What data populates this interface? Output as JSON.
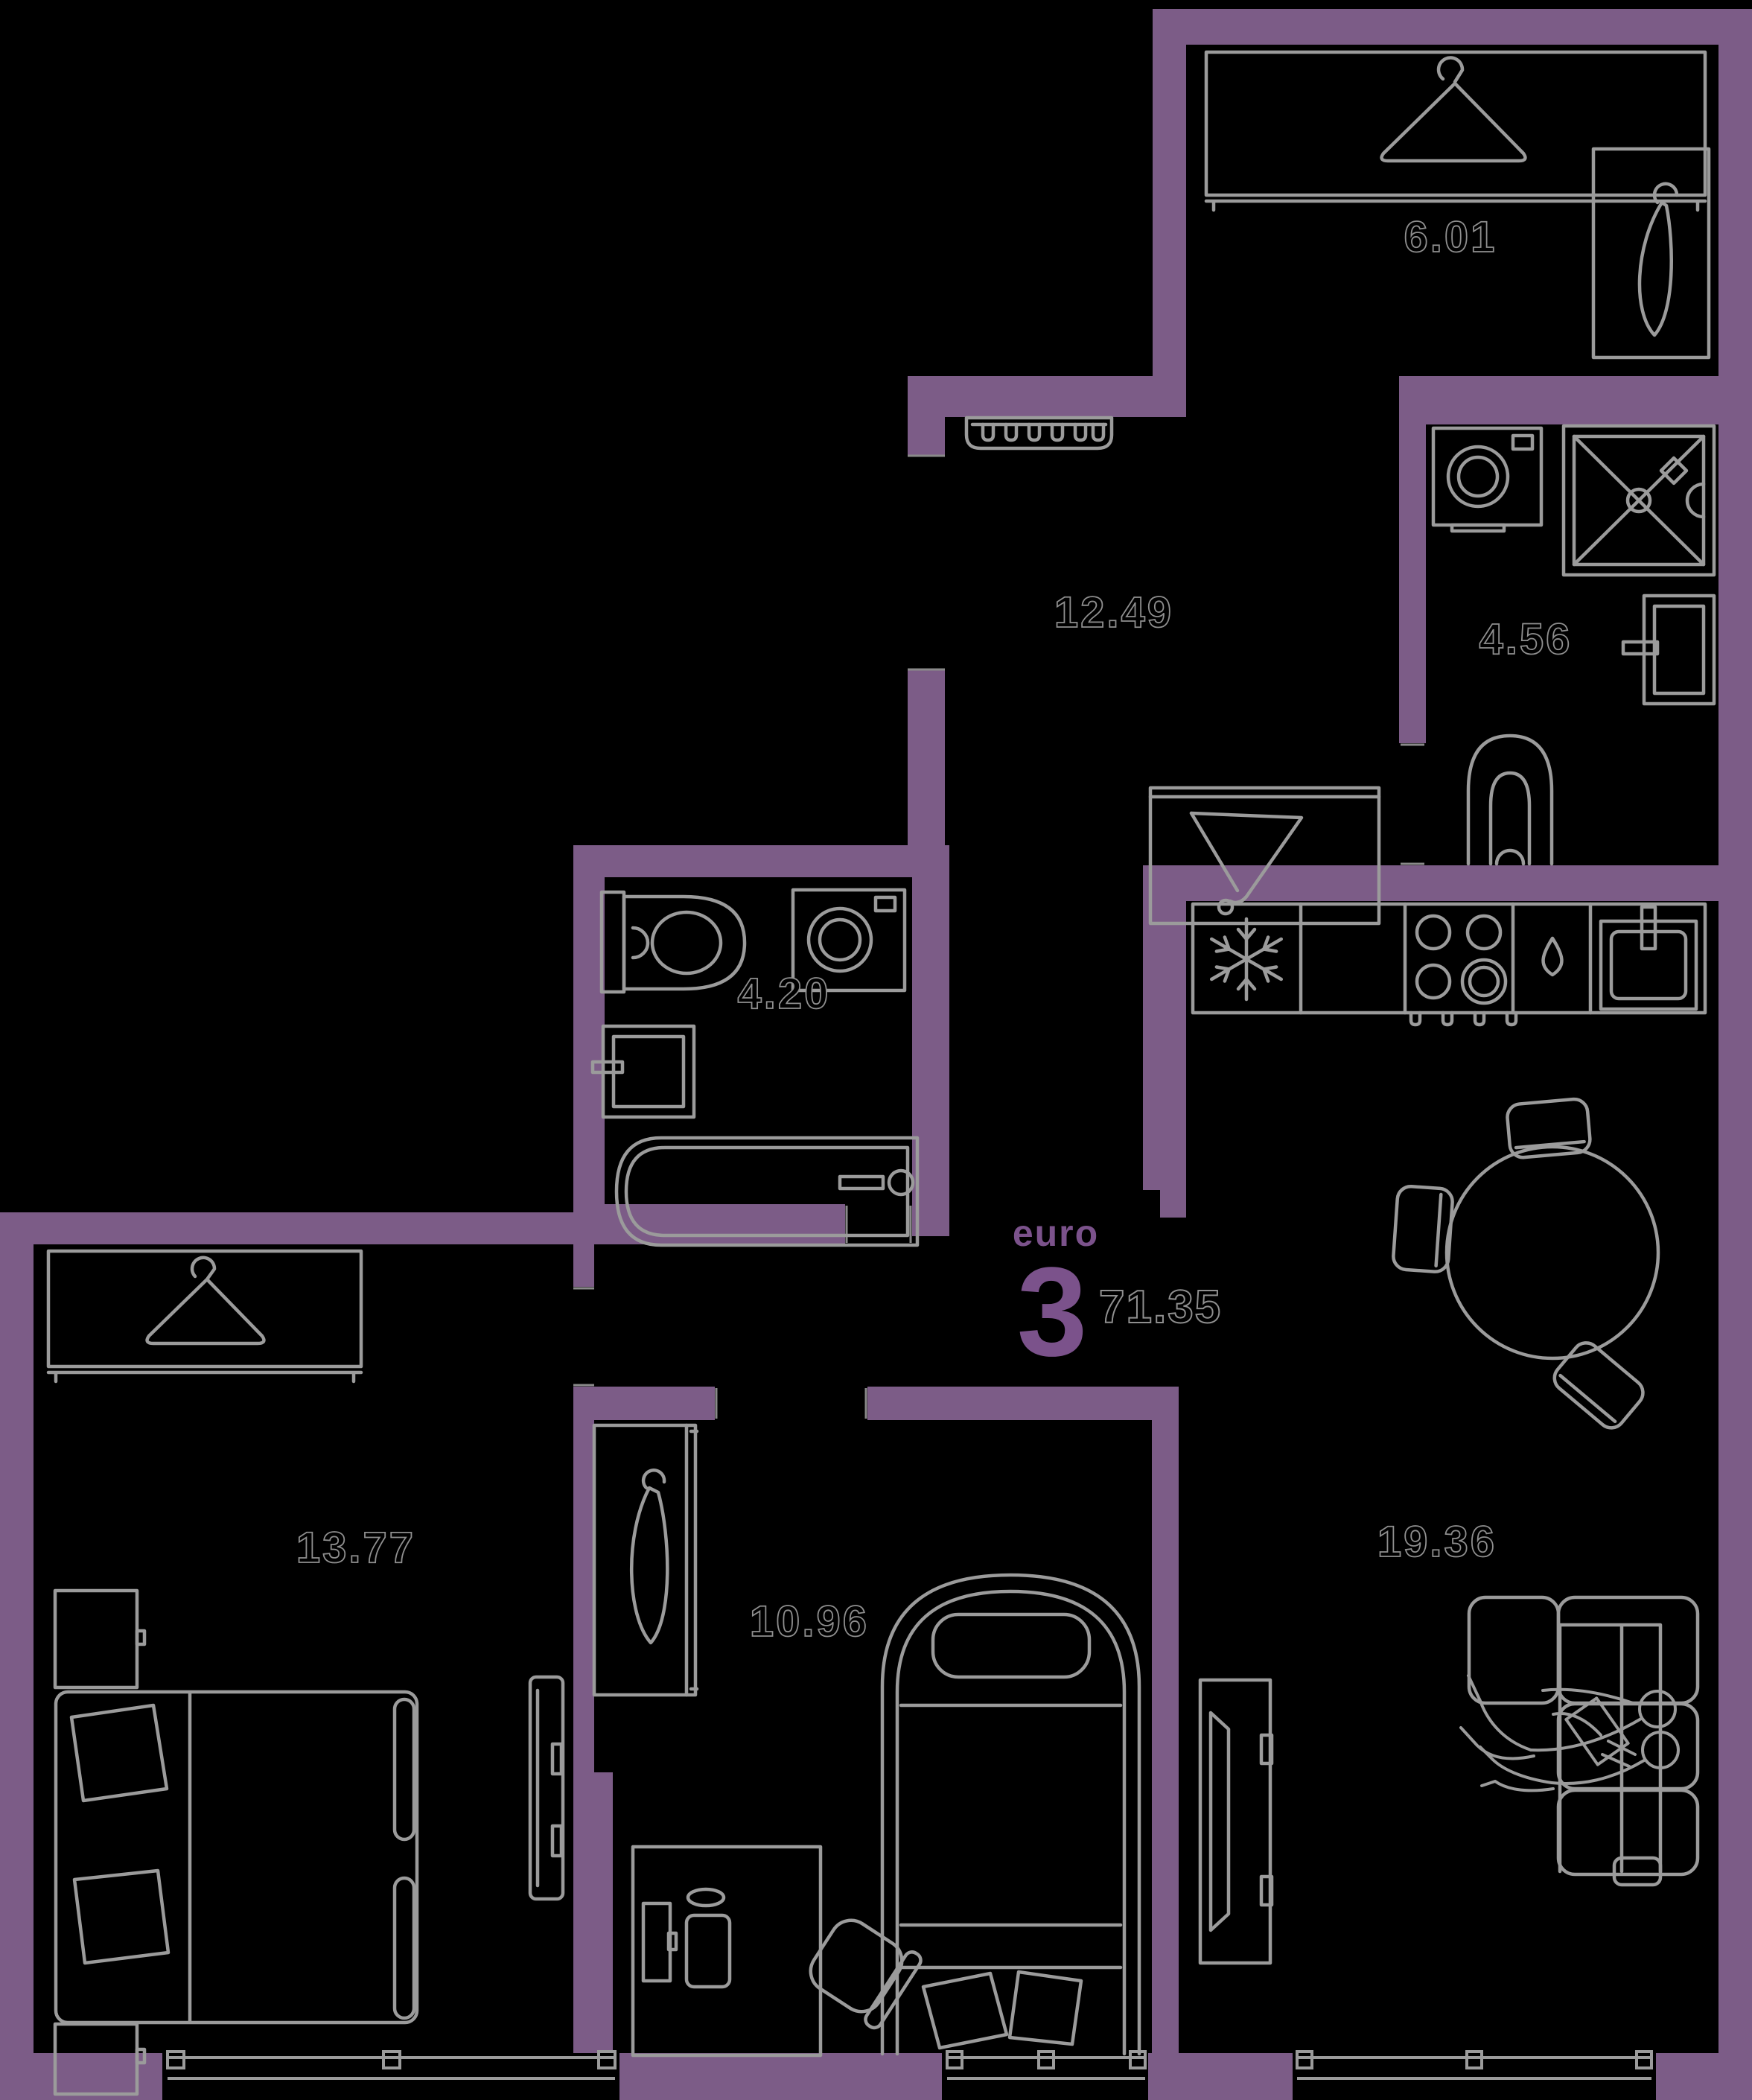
{
  "plan": {
    "format_label": "euro",
    "format_rooms": "3",
    "total_area": "71.35",
    "rooms": [
      {
        "name": "wardrobe-room",
        "area": "6.01"
      },
      {
        "name": "hallway",
        "area": "12.49"
      },
      {
        "name": "shower-room",
        "area": "4.56"
      },
      {
        "name": "bathroom",
        "area": "4.20"
      },
      {
        "name": "bedroom",
        "area": "13.77"
      },
      {
        "name": "child-room",
        "area": "10.96"
      },
      {
        "name": "living-kitchen",
        "area": "19.36"
      }
    ],
    "colors": {
      "background": "#000000",
      "wall": "#7C5C87",
      "accent_text": "#7B528B",
      "furniture_line": "#9B9B9B",
      "label_outline": "#8F8F8F"
    },
    "icons": [
      "hanger-front-icon",
      "hanger-side-icon",
      "coat-rack-icon",
      "coat-console-icon",
      "washing-machine-icon",
      "shower-icon",
      "wash-sink-icon",
      "toilet-icon",
      "bathtub-icon",
      "fridge-snowflake-icon",
      "stove-icon",
      "dishwasher-drop-icon",
      "kitchen-sink-icon",
      "dining-table-icon",
      "chair-icon",
      "sofa-icon",
      "person-icon",
      "tv-icon",
      "bed-icon",
      "desk-icon",
      "desk-chair-icon",
      "wardrobe-icon",
      "window-icon",
      "nightstand-icon"
    ]
  }
}
